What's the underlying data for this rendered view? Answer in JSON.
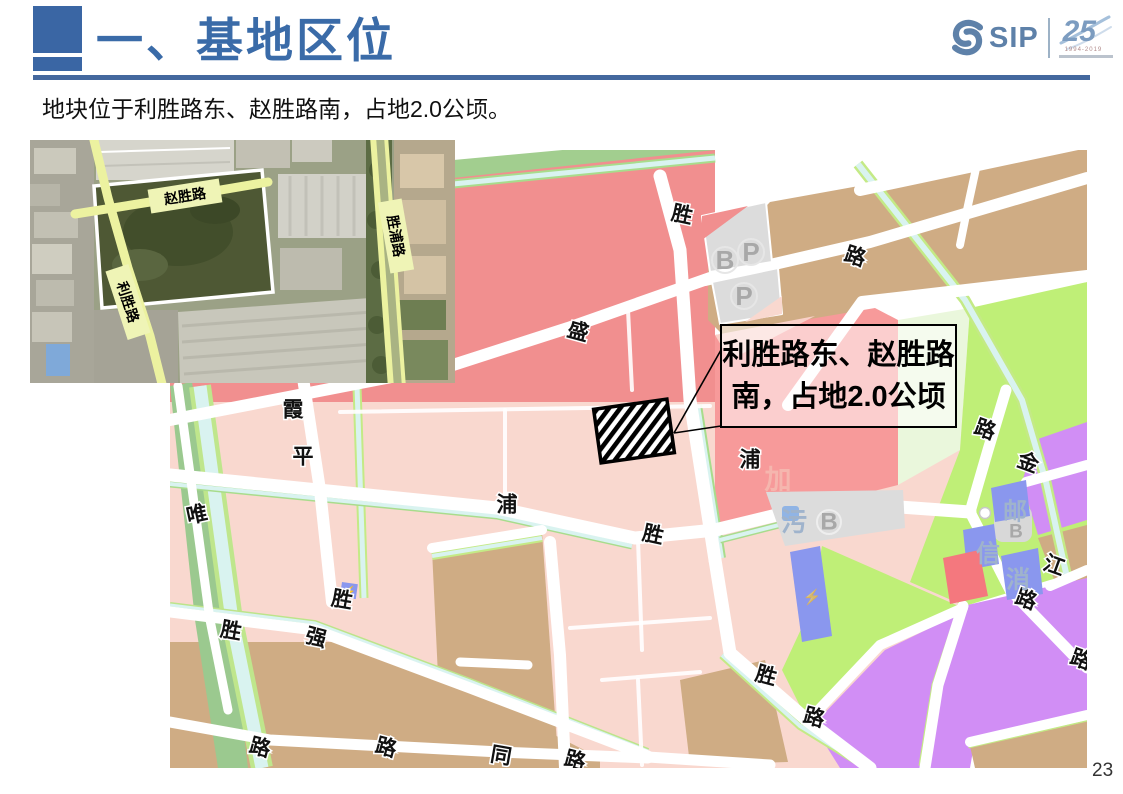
{
  "slide": {
    "title": "一、基地区位",
    "subtitle": "地块位于利胜路东、赵胜路南，占地2.0公顷。",
    "page_number": "23"
  },
  "logo": {
    "name": "SIP",
    "anniversary_number": "25",
    "anniversary_years": "1994-2019"
  },
  "satellite_map": {
    "road_labels": [
      "赵胜路",
      "利胜路",
      "胜浦路"
    ]
  },
  "zoning_map": {
    "callout": {
      "line1": "利胜路东、赵胜路",
      "line2": "南，占地2.0公顷"
    },
    "road_labels": [
      {
        "t": "胜",
        "x": 512,
        "y": 65,
        "r": 12
      },
      {
        "t": "路",
        "x": 685,
        "y": 107,
        "r": 18
      },
      {
        "t": "盛",
        "x": 408,
        "y": 182,
        "r": 15
      },
      {
        "t": "霞",
        "x": 123,
        "y": 260,
        "r": 0
      },
      {
        "t": "平",
        "x": 133,
        "y": 307,
        "r": 0
      },
      {
        "t": "唯",
        "x": 27,
        "y": 365,
        "r": -12
      },
      {
        "t": "浦",
        "x": 337,
        "y": 355,
        "r": 0
      },
      {
        "t": "胜",
        "x": 483,
        "y": 385,
        "r": 12
      },
      {
        "t": "浦",
        "x": 580,
        "y": 310,
        "r": 0
      },
      {
        "t": "金",
        "x": 858,
        "y": 313,
        "r": 20
      },
      {
        "t": "江",
        "x": 884,
        "y": 416,
        "r": 20
      },
      {
        "t": "路",
        "x": 815,
        "y": 280,
        "r": 20
      },
      {
        "t": "路",
        "x": 856,
        "y": 450,
        "r": 20
      },
      {
        "t": "路",
        "x": 911,
        "y": 510,
        "r": 20
      },
      {
        "t": "胜",
        "x": 596,
        "y": 526,
        "r": 15
      },
      {
        "t": "路",
        "x": 644,
        "y": 568,
        "r": 15
      },
      {
        "t": "胜",
        "x": 172,
        "y": 450,
        "r": 10
      },
      {
        "t": "强",
        "x": 146,
        "y": 488,
        "r": 15
      },
      {
        "t": "胜",
        "x": 61,
        "y": 481,
        "r": 10
      },
      {
        "t": "路",
        "x": 90,
        "y": 598,
        "r": 15
      },
      {
        "t": "路",
        "x": 216,
        "y": 598,
        "r": 15
      },
      {
        "t": "同",
        "x": 331,
        "y": 606,
        "r": 10
      },
      {
        "t": "路",
        "x": 405,
        "y": 611,
        "r": 15
      }
    ],
    "faded_labels": [
      {
        "t": "加",
        "x": 608,
        "y": 330,
        "size": 27,
        "color": "#f5b6ae"
      },
      {
        "t": "污",
        "x": 624,
        "y": 372,
        "size": 26,
        "color": "#9fb3cc"
      },
      {
        "t": "邮",
        "x": 845,
        "y": 362,
        "size": 24,
        "color": "#9fb3cc"
      },
      {
        "t": "信",
        "x": 818,
        "y": 404,
        "size": 24,
        "color": "#9fb3cc"
      },
      {
        "t": "消",
        "x": 848,
        "y": 430,
        "size": 24,
        "color": "#9fb3cc"
      }
    ],
    "badges": [
      {
        "t": "B",
        "x": 555,
        "y": 110,
        "size": 26
      },
      {
        "t": "P",
        "x": 581,
        "y": 102,
        "size": 26
      },
      {
        "t": "P",
        "x": 574,
        "y": 146,
        "size": 26
      },
      {
        "t": "B",
        "x": 659,
        "y": 372,
        "size": 24
      },
      {
        "t": "B",
        "x": 846,
        "y": 382,
        "size": 19
      }
    ]
  },
  "colors": {
    "accent_blue": "#3a6ba8",
    "strong_pink": "#f18f8f",
    "light_pink": "#f9d8cf",
    "green": "#a2ce8f",
    "lime_green": "#bfef77",
    "pale_lime": "#eaf7dc",
    "canal_cyan": "#d9f3f0",
    "tan": "#cfac84",
    "purple": "#d18ef5",
    "facility_blue": "#8a97ee",
    "red": "#f4787e",
    "gray": "#dcdcdc"
  }
}
